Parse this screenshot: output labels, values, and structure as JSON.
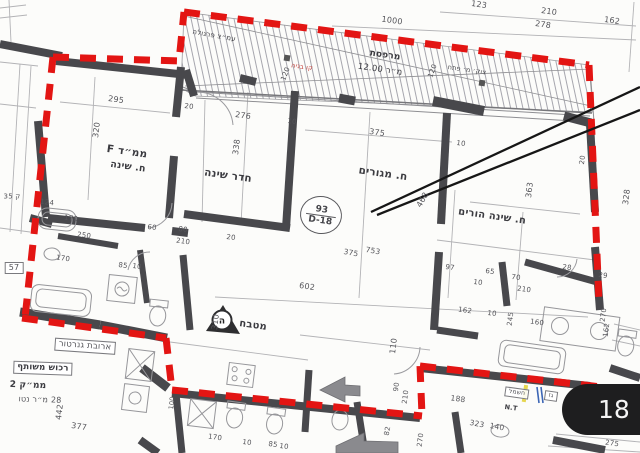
{
  "page": {
    "badge_label": "18"
  },
  "stamp": {
    "top": "93",
    "bottom": "D-18"
  },
  "marker": {
    "letter": "ה"
  },
  "colors": {
    "boundary_red": "#e31513",
    "wall_dark": "#48484c",
    "line_gray": "#b3b3b6",
    "annotation_black": "#161616",
    "badge_bg": "#1e1e1f",
    "badge_text": "#f5f5f5",
    "utility_yellow": "#e6d64f",
    "utility_blue": "#3c66b5",
    "red_text": "#c43b36"
  },
  "plan": {
    "room_labels": [
      {
        "t": "ממ״ד F",
        "x": 127,
        "y": 152,
        "r": 8,
        "s": 10.5,
        "b": 1
      },
      {
        "t": "ח. שינה",
        "x": 128,
        "y": 167,
        "r": 8,
        "s": 9.5,
        "b": 1
      },
      {
        "t": "חדר שינה",
        "x": 228,
        "y": 176,
        "r": 8,
        "s": 10.5,
        "b": 1
      },
      {
        "t": "ח. מגורים",
        "x": 383,
        "y": 174,
        "r": 8,
        "s": 10.5,
        "b": 1
      },
      {
        "t": "ח. שינה הורים",
        "x": 492,
        "y": 217,
        "r": 8,
        "s": 10,
        "b": 1
      },
      {
        "t": "מטבח",
        "x": 253,
        "y": 326,
        "r": 8,
        "s": 10,
        "b": 1
      }
    ],
    "annotation_labels": [
      {
        "t": "עמ״צ פרגולה",
        "x": 214,
        "y": 36,
        "r": 10,
        "s": 7,
        "c": "#3f3f44"
      },
      {
        "t": "קו בניה",
        "x": 302,
        "y": 67,
        "r": 8,
        "s": 6.5,
        "c": "#c43b36"
      },
      {
        "t": "מרפסת",
        "x": 385,
        "y": 56,
        "r": 8,
        "s": 9,
        "b": 1
      },
      {
        "t": "מ״ר 12.00",
        "x": 380,
        "y": 70,
        "r": 8,
        "s": 8.5,
        "c": "#3a3a3f"
      },
      {
        "t": "צוק׳ מ׳ פתח",
        "x": 467,
        "y": 70,
        "r": 8,
        "s": 6.5,
        "c": "#4a4a4e"
      },
      {
        "t": "ארובת גנרטור",
        "x": 85,
        "y": 346,
        "r": 4,
        "s": 8.5,
        "box": 1
      },
      {
        "t": "רכוש משותף",
        "x": 43,
        "y": 368,
        "r": 2,
        "s": 8.5,
        "b": 1,
        "box": 1
      },
      {
        "t": "ממ״ק 2",
        "x": 28,
        "y": 386,
        "r": 2,
        "s": 9,
        "b": 1
      },
      {
        "t": "28 מ״ר נטו",
        "x": 40,
        "y": 400,
        "r": 2,
        "s": 8
      },
      {
        "t": "חשמל",
        "x": 517,
        "y": 393,
        "r": 8,
        "s": 6,
        "box": 1
      },
      {
        "t": "גז",
        "x": 551,
        "y": 396,
        "r": 8,
        "s": 6,
        "box": 1
      },
      {
        "t": "N.T",
        "x": 511,
        "y": 408,
        "r": 8,
        "s": 6.5,
        "b": 1
      },
      {
        "t": "275",
        "x": 612,
        "y": 444,
        "r": 8,
        "s": 7
      }
    ],
    "dimension_labels": [
      {
        "t": "1000",
        "x": 392,
        "y": 21,
        "r": 8,
        "s": 8
      },
      {
        "t": "123",
        "x": 479,
        "y": 5,
        "r": 8,
        "s": 8
      },
      {
        "t": "210",
        "x": 549,
        "y": 12,
        "r": 8,
        "s": 8
      },
      {
        "t": "278",
        "x": 543,
        "y": 25,
        "r": 8,
        "s": 8
      },
      {
        "t": "162",
        "x": 612,
        "y": 21,
        "r": 8,
        "s": 8
      },
      {
        "t": "295",
        "x": 116,
        "y": 100,
        "r": 8,
        "s": 8
      },
      {
        "t": "320",
        "x": 97,
        "y": 130,
        "r": -83,
        "s": 8
      },
      {
        "t": "20",
        "x": 189,
        "y": 107,
        "r": 8,
        "s": 7
      },
      {
        "t": "276",
        "x": 243,
        "y": 116,
        "r": 8,
        "s": 8
      },
      {
        "t": "10",
        "x": 292,
        "y": 122,
        "r": 8,
        "s": 7
      },
      {
        "t": "338",
        "x": 237,
        "y": 147,
        "r": -83,
        "s": 8
      },
      {
        "t": "375",
        "x": 377,
        "y": 133,
        "r": 8,
        "s": 8
      },
      {
        "t": "10",
        "x": 461,
        "y": 144,
        "r": 8,
        "s": 7
      },
      {
        "t": "120",
        "x": 286,
        "y": 74,
        "r": -70,
        "s": 7
      },
      {
        "t": "120",
        "x": 433,
        "y": 71,
        "r": -70,
        "s": 7
      },
      {
        "t": "20",
        "x": 583,
        "y": 160,
        "r": -83,
        "s": 7
      },
      {
        "t": "363",
        "x": 530,
        "y": 190,
        "r": -83,
        "s": 8
      },
      {
        "t": "328",
        "x": 627,
        "y": 197,
        "r": -83,
        "s": 8
      },
      {
        "t": "468",
        "x": 423,
        "y": 200,
        "r": -60,
        "s": 8
      },
      {
        "t": "375",
        "x": 351,
        "y": 253,
        "r": 10,
        "s": 7.5
      },
      {
        "t": "753",
        "x": 373,
        "y": 251,
        "r": 10,
        "s": 7.5
      },
      {
        "t": "110",
        "x": 394,
        "y": 346,
        "r": -83,
        "s": 8
      },
      {
        "t": "602",
        "x": 307,
        "y": 287,
        "r": 8,
        "s": 8
      },
      {
        "t": "310",
        "x": 216,
        "y": 322,
        "r": -83,
        "s": 8
      },
      {
        "t": "250",
        "x": 84,
        "y": 236,
        "r": 8,
        "s": 7
      },
      {
        "t": "60",
        "x": 152,
        "y": 228,
        "r": 8,
        "s": 7
      },
      {
        "t": "80",
        "x": 183,
        "y": 230,
        "r": 8,
        "s": 7
      },
      {
        "t": "210",
        "x": 183,
        "y": 242,
        "r": 8,
        "s": 7
      },
      {
        "t": "20",
        "x": 231,
        "y": 238,
        "r": 8,
        "s": 7
      },
      {
        "t": "85",
        "x": 123,
        "y": 266,
        "r": 8,
        "s": 7
      },
      {
        "t": "10",
        "x": 137,
        "y": 267,
        "r": 8,
        "s": 7
      },
      {
        "t": "170",
        "x": 63,
        "y": 259,
        "r": 8,
        "s": 7
      },
      {
        "t": "170",
        "x": 71,
        "y": 219,
        "r": 8,
        "s": 7
      },
      {
        "t": "124",
        "x": 47,
        "y": 203,
        "r": 8,
        "s": 7
      },
      {
        "t": "ק 35",
        "x": 12,
        "y": 197,
        "r": 0,
        "s": 7
      },
      {
        "t": "442",
        "x": 60,
        "y": 412,
        "r": -83,
        "s": 8
      },
      {
        "t": "377",
        "x": 79,
        "y": 427,
        "r": 8,
        "s": 8
      },
      {
        "t": "97",
        "x": 450,
        "y": 268,
        "r": 8,
        "s": 7
      },
      {
        "t": "65",
        "x": 490,
        "y": 272,
        "r": 8,
        "s": 7
      },
      {
        "t": "70",
        "x": 516,
        "y": 278,
        "r": 8,
        "s": 7
      },
      {
        "t": "210",
        "x": 524,
        "y": 290,
        "r": 8,
        "s": 7
      },
      {
        "t": "10",
        "x": 478,
        "y": 283,
        "r": 8,
        "s": 7
      },
      {
        "t": "28",
        "x": 567,
        "y": 268,
        "r": 8,
        "s": 7
      },
      {
        "t": "29",
        "x": 603,
        "y": 276,
        "r": 8,
        "s": 7
      },
      {
        "t": "162",
        "x": 465,
        "y": 311,
        "r": 8,
        "s": 7
      },
      {
        "t": "10",
        "x": 492,
        "y": 314,
        "r": 8,
        "s": 7
      },
      {
        "t": "245",
        "x": 511,
        "y": 319,
        "r": -83,
        "s": 7
      },
      {
        "t": "160",
        "x": 537,
        "y": 323,
        "r": 8,
        "s": 7
      },
      {
        "t": "270",
        "x": 604,
        "y": 315,
        "r": -83,
        "s": 7
      },
      {
        "t": "162",
        "x": 607,
        "y": 330,
        "r": -83,
        "s": 7
      },
      {
        "t": "90",
        "x": 397,
        "y": 387,
        "r": -83,
        "s": 7
      },
      {
        "t": "210",
        "x": 406,
        "y": 397,
        "r": -83,
        "s": 7
      },
      {
        "t": "188",
        "x": 458,
        "y": 399,
        "r": 8,
        "s": 7.5
      },
      {
        "t": "270",
        "x": 421,
        "y": 440,
        "r": -83,
        "s": 7
      },
      {
        "t": "323",
        "x": 477,
        "y": 424,
        "r": 10,
        "s": 7.5
      },
      {
        "t": "140",
        "x": 497,
        "y": 427,
        "r": 10,
        "s": 7.5
      },
      {
        "t": "170",
        "x": 215,
        "y": 438,
        "r": 8,
        "s": 7
      },
      {
        "t": "10",
        "x": 247,
        "y": 443,
        "r": 8,
        "s": 7
      },
      {
        "t": "85",
        "x": 273,
        "y": 445,
        "r": 8,
        "s": 7
      },
      {
        "t": "10",
        "x": 284,
        "y": 447,
        "r": 8,
        "s": 7
      },
      {
        "t": "82",
        "x": 388,
        "y": 431,
        "r": -80,
        "s": 7
      },
      {
        "t": "100",
        "x": 172,
        "y": 403,
        "r": -83,
        "s": 6.5
      },
      {
        "t": "57",
        "x": 14,
        "y": 268,
        "r": 0,
        "s": 8,
        "box": 1
      }
    ]
  }
}
